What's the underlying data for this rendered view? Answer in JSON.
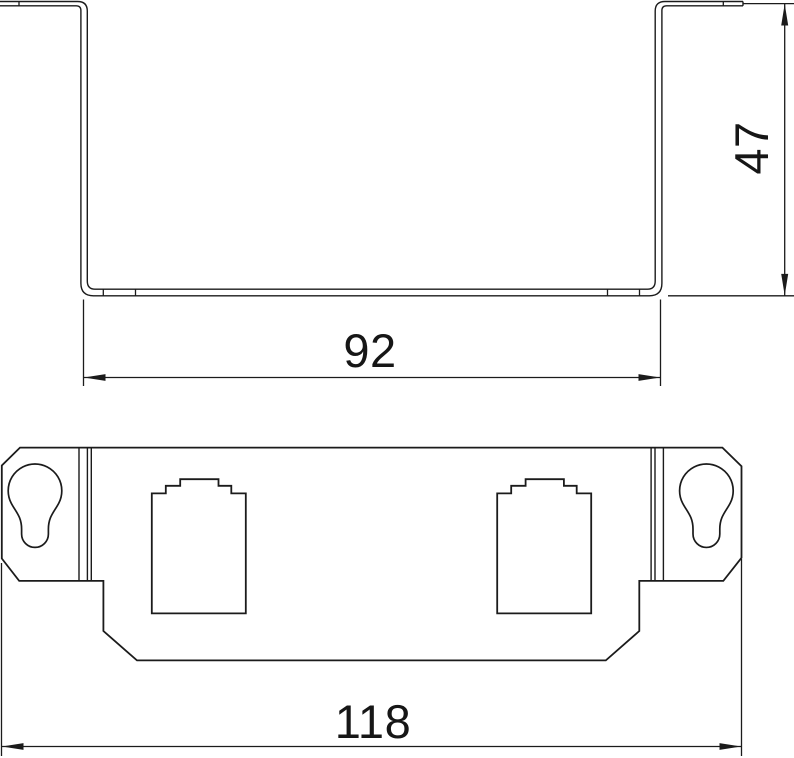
{
  "drawing": {
    "background": "#ffffff",
    "line_color": "#1b1b1b",
    "views": {
      "side_view_name": "u-channel-side-profile",
      "front_view_name": "front-view-with-keyholes-and-jack-openings"
    },
    "paths": [
      {
        "name": "side-view-outer-contour",
        "w": 1.4,
        "d": "M 0,1.5 H 77.5 Q 87.3,1.5 87.3,11 V 281 Q 87.3,289.2 95,289.2 H 647.5 Q 655.2,289.2 655.2,281 V 11 Q 655.2,1.5 665,1.5 H 743"
      },
      {
        "name": "side-view-inner-contour",
        "w": 1.4,
        "d": "M 0,5.8 H 76.2 Q 80.9,5.8 80.9,10.6 V 283.3 Q 80.9,295.8 93.4,295.8 H 649.3 Q 661.9,295.8 661.9,283.3 V 10.6 Q 661.9,5.8 666.6,5.8 H 743"
      },
      {
        "name": "side-view-flange-end-cap",
        "w": 1.4,
        "d": "M 743,1.5 V 5.8"
      },
      {
        "name": "side-view-bend-ticks",
        "w": 1.3,
        "d": "M 19,1.3 V 6 M 723.3,1.3 V 6 M 103.3,289 V 296 M 135.5,289 V 296 M 607.5,289 V 296 M 639.5,289 V 296"
      },
      {
        "name": "dimension-92-extension-and-line",
        "w": 1.3,
        "d": "M 83.5,299.5 V 386 M 660.5,299.5 V 386 M 84,377.5 H 660"
      },
      {
        "name": "dimension-92-arrowheads",
        "w": 0,
        "fill": "#1b1b1b",
        "d": "M 83.9,377.5 L 105.5,374.1 L 105.5,380.9 Z M 660.1,377.5 L 638.5,374.1 L 638.5,380.9 Z"
      },
      {
        "name": "dimension-47-extension-and-line",
        "w": 1.3,
        "d": "M 743.5,3.6 H 794 M 668,295.8 H 794 M 784.7,4 V 295.5"
      },
      {
        "name": "dimension-47-arrowheads",
        "w": 0,
        "fill": "#1b1b1b",
        "d": "M 784.7,3.9 L 781.2,25.5 L 788.2,25.5 Z M 784.7,295.5 L 781.2,273.9 L 788.2,273.9 Z"
      },
      {
        "name": "front-view-outline",
        "w": 1.8,
        "d": "M 20,447.6 H 722.4 L 741.5,466.2 V 557.8 L 723.3,580.9 H 639.3 V 631 L 605.8,660.4 H 137 L 103.4,631 V 580.9 H 19.2 L 1.8,558.5 V 465.5 Z"
      },
      {
        "name": "front-view-tab-divider-lines",
        "w": 1.4,
        "d": "M 79,447.6 V 580.9 M 87.4,447.6 V 580.9 M 91.3,447.6 V 580.9 M 651.1,447.6 V 580.9 M 655,447.6 V 580.9 M 663.4,447.6 V 580.9"
      },
      {
        "name": "keyhole-slot-left",
        "w": 1.7,
        "d": "M 11.2,503.1 A 26.8 26.8 0 1 1 58.8,503.1 C 54.5,511.5 48.4,516.5 48.4,529 L 48.4,534 A 13.4 13.4 0 1 1 21.6,534 L 21.6,529 C 21.6,516.5 15.5,511.5 11.2,503.1 Z"
      },
      {
        "name": "keyhole-slot-right",
        "w": 1.7,
        "d": "M 682.6,503.1 A 26.8 26.8 0 1 1 730.2,503.1 C 725.9,511.5 719.8,516.5 719.8,529 L 719.8,534 A 13.4 13.4 0 1 1 693,534 L 693,529 C 693,516.5 686.9,511.5 682.6,503.1 Z"
      },
      {
        "name": "jack-opening-left",
        "w": 1.8,
        "d": "M 151.8,613.4 V 493.4 H 165.8 V 485.8 H 180.2 V 479.2 H 218.5 V 485.8 H 231.3 V 493.4 H 245.8 V 613.4 Z"
      },
      {
        "name": "jack-opening-right",
        "w": 1.8,
        "d": "M 497.2,613.4 V 493.4 H 511.2 V 485.8 H 525.6 V 479.2 H 563.9 V 485.8 H 576.7 V 493.4 H 591.2 V 613.4 Z"
      },
      {
        "name": "dimension-118-extension-and-line",
        "w": 1.3,
        "d": "M 1.5,563 V 756 M 741.5,559 V 756 M 2,746.5 H 741"
      },
      {
        "name": "dimension-118-arrowheads",
        "w": 0,
        "fill": "#1b1b1b",
        "d": "M 1.9,746.5 L 23.5,743.1 L 23.5,749.9 Z M 741.1,746.5 L 719.5,743.1 L 719.5,749.9 Z"
      }
    ]
  },
  "dimensions": {
    "height": {
      "value": "47",
      "orientation": "vertical"
    },
    "inner_width": {
      "value": "92",
      "orientation": "horizontal"
    },
    "overall_width": {
      "value": "118",
      "orientation": "horizontal"
    }
  }
}
